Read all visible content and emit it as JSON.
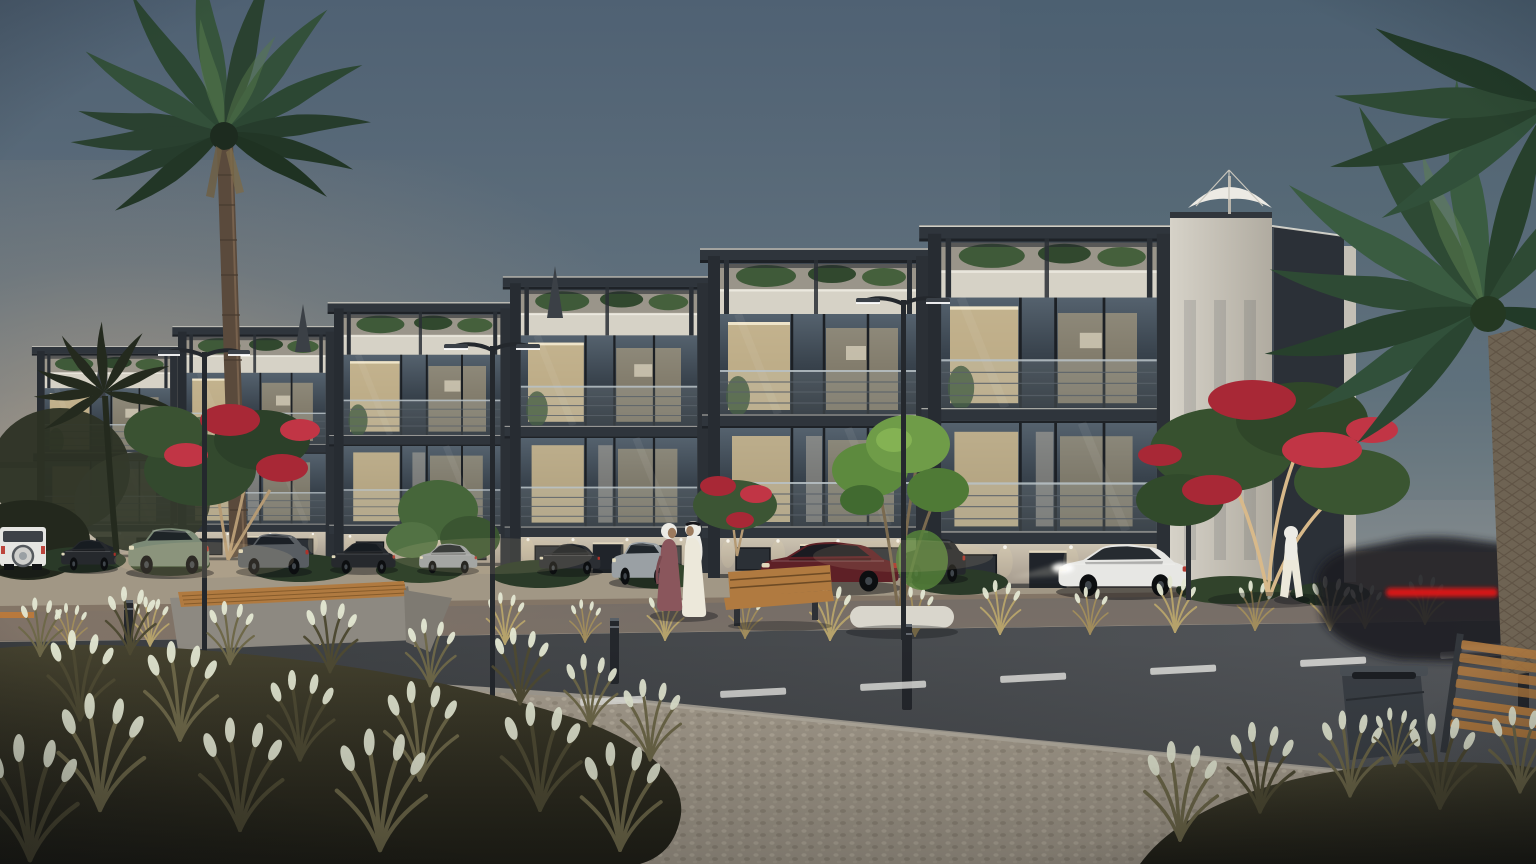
{
  "meta": {
    "title": "Residential complex exterior rendering at dusk",
    "type": "architectural-visualization",
    "time_of_day": "dusk",
    "weather": "clear"
  },
  "palette": {
    "sky-top": "#4f6173",
    "sky-mid": "#64747f",
    "sky-horizon": "#958f85",
    "horizon-warm": "#deb68c",
    "building-frame": "#2f353c",
    "wall-stone": "#b3aa99",
    "wall-light": "#cfc8b8",
    "parapet": "#d6d2c6",
    "glass-dark": "#39434e",
    "room-glow": "#e0c897",
    "led-strip": "#f2efe3",
    "palm-green": "#33503a",
    "palm-dark": "#27402c",
    "leaf-green": "#46663a",
    "leaf-bright": "#6f9c48",
    "flower-red": "#a82836",
    "trunk-lit": "#d8b98a",
    "grass-gold": "#a08c5c",
    "grass-olive": "#6e6849",
    "seed-head": "#e4e8d3",
    "road-asphalt": "#43464a",
    "lane-mark": "#e6e6e2",
    "curb": "#c2baab",
    "pebble": "#a59c8d",
    "sidewalk-warm": "#a19785",
    "car-white": "#e7e7e4",
    "car-sage": "#7b8a76",
    "car-gray": "#585d62",
    "car-silver": "#9aa0a4",
    "car-maroon": "#5e2026",
    "car-dark": "#26292d",
    "car-green-dark": "#223832",
    "tail-red": "#e01818",
    "wood-bench": "#b07a40",
    "concrete-bench": "#8d8981",
    "bin-gray": "#3a3f45",
    "bollard-dark": "#24272c",
    "umbrella-white": "#eceae4",
    "abaya-mauve": "#8a565c",
    "kandura-white": "#ece8da",
    "skin-tone": "#9c7b5e",
    "planter-white": "#d9d6cc",
    "lamp-metal": "#24282d"
  },
  "scene": {
    "description": "Photorealistic dusk rendering of a modern low-rise residential complex with lit interiors, landscaped street, parked cars and pedestrians in traditional Gulf attire",
    "building": {
      "label": "modern low-rise apartment complex",
      "levels": "ground floor + 2 glazed floors + roof terraces",
      "features": [
        "dark charcoal pergola frames with thin LED edge lighting",
        "glass balustrade balconies",
        "floor-to-ceiling glazing with warm interior lighting",
        "stone-clad ground floor with downlights",
        "roof terrace planting",
        "white patio umbrella on right roof terrace",
        "closed umbrellas on left roof terraces"
      ]
    },
    "vegetation": [
      {
        "label": "tall palm tree",
        "position": "left foreground"
      },
      {
        "label": "date palm with textured trunk",
        "position": "right edge"
      },
      {
        "label": "small palm silhouette",
        "position": "far left"
      },
      {
        "label": "red flowering trees",
        "count": 3
      },
      {
        "label": "green tree in round white planter",
        "position": "center"
      },
      {
        "label": "dry ornamental grasses with pale seed heads",
        "position": "foreground"
      },
      {
        "label": "golden grasses along parking strip"
      },
      {
        "label": "hedges along building base"
      }
    ],
    "street": [
      {
        "label": "asphalt road with dashed white lane markings"
      },
      {
        "label": "pebbled pedestrian walkway",
        "position": "foreground"
      },
      {
        "label": "stone forecourt with parallel parking strip"
      },
      {
        "label": "light curb lines"
      }
    ],
    "vehicles": {
      "parked": [
        {
          "label": "white boxy SUV with rear-mounted spare wheel",
          "color": "#e7e7e4"
        },
        {
          "label": "small dark sedan",
          "color": "#26292d"
        },
        {
          "label": "sage-green boxy SUV",
          "color": "#7b8a76"
        },
        {
          "label": "gray SUV",
          "color": "#585d62"
        },
        {
          "label": "dark sedan",
          "color": "#26292d"
        },
        {
          "label": "silver compact car",
          "color": "#9aa0a4"
        },
        {
          "label": "dark hatchback",
          "color": "#2b2e33"
        },
        {
          "label": "silver SUV behind pedestrians",
          "color": "#9aa0a4"
        },
        {
          "label": "maroon sedan",
          "color": "#5e2026"
        },
        {
          "label": "dark SUV behind planter tree",
          "color": "#24272b"
        },
        {
          "label": "white luxury sedan with lit headlights",
          "color": "#e7e7e4"
        }
      ],
      "moving": [
        {
          "label": "motion-blurred dark car with red tail-light streak",
          "position": "bottom right"
        }
      ],
      "foreground": [
        {
          "label": "dark green fastback sedan",
          "color": "#223832",
          "position": "bottom left"
        }
      ]
    },
    "people": [
      {
        "label": "woman in mauve abaya with white hijab",
        "position": "center sidewalk"
      },
      {
        "label": "man in white kandura and ghutra",
        "position": "center sidewalk, talking with woman"
      },
      {
        "label": "man in white robe walking",
        "position": "right, near building entrance"
      }
    ],
    "furniture_and_fixtures": [
      {
        "label": "angular concrete planter bench with wood slat top",
        "position": "left"
      },
      {
        "label": "wood slat bench with backrest",
        "position": "center"
      },
      {
        "label": "wood slat bench",
        "position": "bottom right corner"
      },
      {
        "label": "dark metal litter bin",
        "position": "right walkway"
      },
      {
        "label": "dark bollards",
        "count": 4
      },
      {
        "label": "double-arm street lamps",
        "count": 3
      },
      {
        "label": "short pole",
        "position": "near white sedan"
      }
    ],
    "lighting": {
      "ambient": "blue-hour dusk, warm glow on left horizon",
      "sources": [
        "warm interior room lights",
        "LED strips along pergola and slab edges",
        "facade wall-washer downlights",
        "street lamp heads",
        "headlight glow of white sedan",
        "red tail-light streak of moving car"
      ]
    }
  }
}
